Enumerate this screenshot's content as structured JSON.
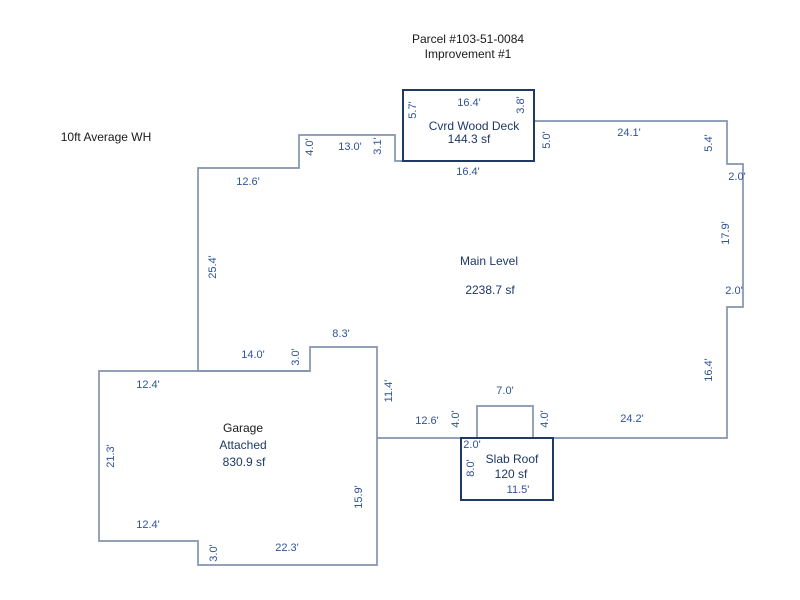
{
  "title": {
    "line1": "Parcel #103-51-0084",
    "line2": "Improvement #1"
  },
  "notes": {
    "wall_height": "10ft Average WH"
  },
  "areas": {
    "main": {
      "name": "Main Level",
      "area": "2238.7 sf"
    },
    "deck": {
      "name": "Cvrd Wood Deck",
      "area": "144.3 sf"
    },
    "garage": {
      "name": "Garage",
      "type": "Attached",
      "area": "830.9 sf"
    },
    "slab": {
      "name": "Slab Roof",
      "area": "120 sf"
    }
  },
  "dims": {
    "deck_top": "16.4'",
    "deck_left": "5.7'",
    "deck_right_upper": "3.8'",
    "deck_bottom": "16.4'",
    "deck_right_lower": "5.0'",
    "top_seg1": "12.6'",
    "top_step_up": "4.0'",
    "top_seg2": "13.0'",
    "top_step_down": "3.1'",
    "top_seg3": "24.1'",
    "ne_step_down": "5.4'",
    "ne_step_out": "2.0'",
    "east_upper": "17.9'",
    "east_step_in": "2.0'",
    "east_lower": "16.4'",
    "west_side": "25.4'",
    "bottom_east": "24.2'",
    "bottom_mid": "12.6'",
    "bump_left": "4.0'",
    "bump_top": "7.0'",
    "bump_right": "4.0'",
    "slab_inset": "2.0'",
    "slab_left": "8.0'",
    "slab_bottom": "11.5'",
    "garage_top": "12.4'",
    "notch_bottom": "14.0'",
    "notch_rise": "3.0'",
    "notch_top": "8.3'",
    "notch_right": "11.4'",
    "garage_west": "21.3'",
    "garage_sw": "12.4'",
    "garage_sw_step": "3.0'",
    "garage_bottom": "22.3'",
    "garage_east": "15.9'"
  },
  "colors": {
    "ink": "#1a1a1a",
    "dim": "#2F5496",
    "navy": "#1F3864",
    "line": "#8294AE",
    "bg": "#ffffff"
  }
}
